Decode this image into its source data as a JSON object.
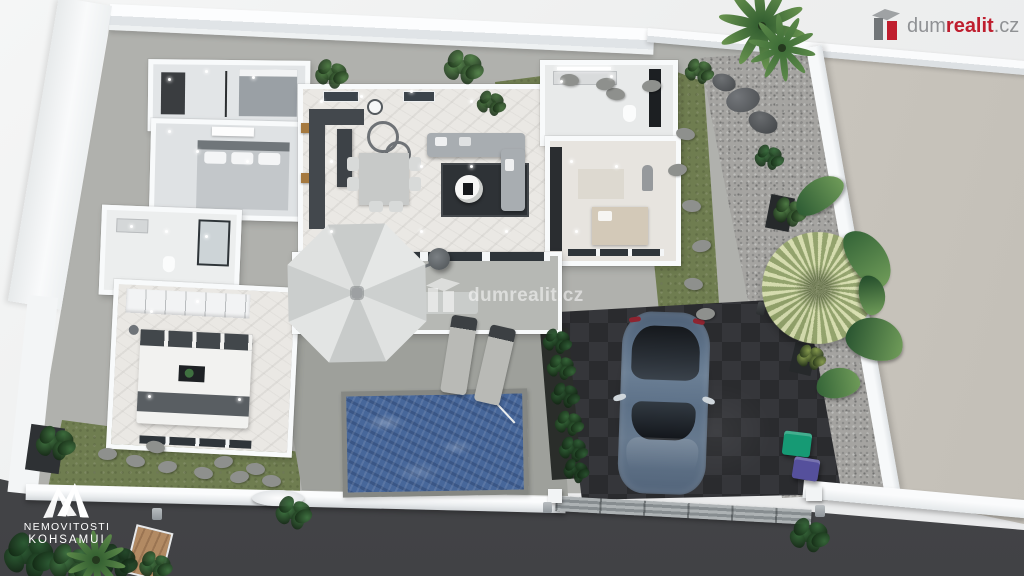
{
  "branding": {
    "dumrealit_logo": {
      "icon": "dumrealit-box-icon",
      "part_gray": "dum",
      "part_red": "realit",
      "part_suffix": ".cz"
    },
    "center_watermark": {
      "icon": "dumrealit-box-icon",
      "text": "dumrealit.cz"
    },
    "agency_logo": {
      "icon": "twin-peaks-icon",
      "line1": "NEMOVITOSTI",
      "line2": "KOHSAMUI"
    }
  },
  "palette": {
    "background_outside": "#f0f1f1",
    "wall_white": "#f8fafb",
    "neighbor_concrete": "#c9c5bd",
    "road": "#47484b",
    "driveway_pavers": "#2d2e31",
    "pool_water": "#47679a",
    "pool_deck": "#9ea09b",
    "grass": "#6f7d50",
    "gravel": "#a5a4a1",
    "marble_floor": "#eae8e4",
    "terrace_floor": "#b7b9b5",
    "car_body": "#5e7389",
    "bin_green": "#169a74",
    "bin_purple": "#55509c",
    "logo_red": "#bf1e2e",
    "logo_gray": "#8f9194",
    "umbrella_canopy": "#d7d9d8"
  },
  "scene": {
    "type": "3d-floorplan-render",
    "rooms": [
      "bedroom-1",
      "bedroom-2",
      "bathroom-1",
      "master-bedroom",
      "hallway",
      "kitchen-dining-living",
      "bathroom-2",
      "walk-in-closet",
      "covered-terrace"
    ],
    "exterior": [
      "swimming-pool",
      "pool-deck",
      "sun-loungers",
      "cantilever-umbrella",
      "driveway",
      "parked-car",
      "garden-lawn",
      "gravel-path",
      "stepping-stones",
      "palm-trees",
      "waste-bins",
      "sliding-gate",
      "perimeter-wall",
      "street"
    ]
  }
}
